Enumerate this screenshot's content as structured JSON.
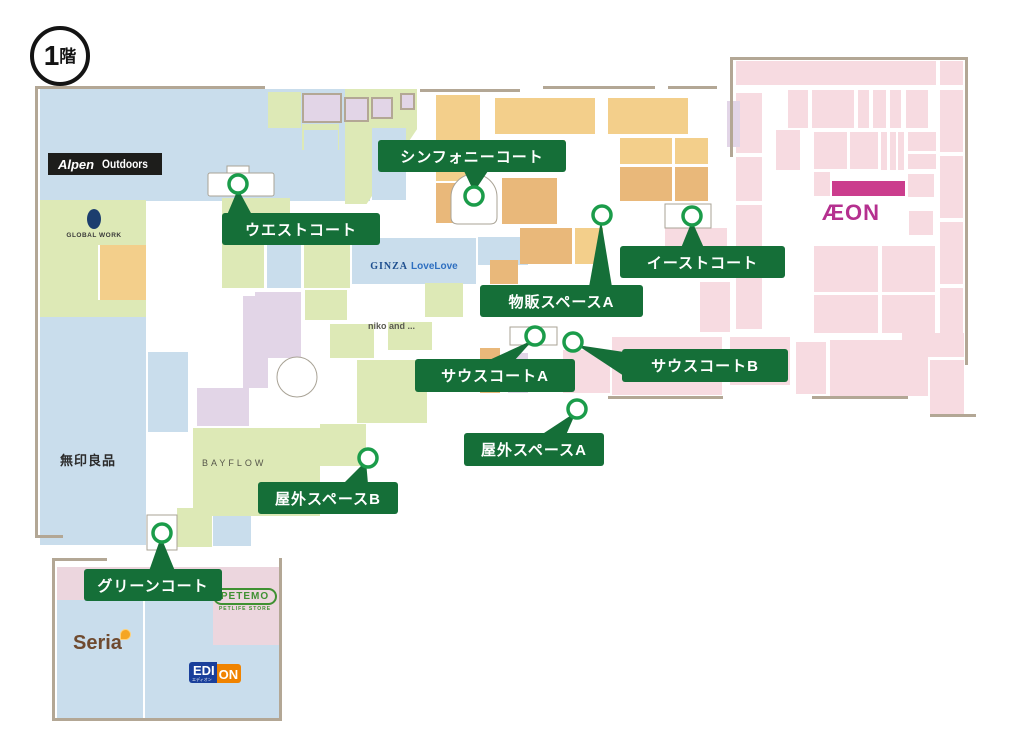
{
  "floor": {
    "number": "1",
    "suffix": "階"
  },
  "areas": {
    "symphony": {
      "label": "シンフォニーコート"
    },
    "west": {
      "label": "ウエストコート"
    },
    "east": {
      "label": "イーストコート"
    },
    "sales_a": {
      "label": "物販スペースA"
    },
    "south_a": {
      "label": "サウスコートA"
    },
    "south_b": {
      "label": "サウスコートB"
    },
    "outdoor_a": {
      "label": "屋外スペースA"
    },
    "outdoor_b": {
      "label": "屋外スペースB"
    },
    "green": {
      "label": "グリーンコート"
    }
  },
  "stores": {
    "alpen_brand": "Alpen",
    "alpen_sub": "Outdoors",
    "global_work": "GLOBAL WORK",
    "ginza_brand": "GINZA",
    "ginza_sub": "LoveLove",
    "niko": "niko and ...",
    "muji": "無印良品",
    "bayflow": "BAYFLOW",
    "aeon": "ÆON",
    "seria": "Seria",
    "petemo": "PETEMO",
    "petemo_sub": "PETLIFE STORE",
    "edion_part1": "EDI",
    "edion_part2": "ON",
    "edion_sub": "エディオン"
  },
  "colors": {
    "area_label_green": "#156f38",
    "marker_ring_green": "#1b9c4a",
    "map_blue": "#c9ddec",
    "map_green": "#dde9b6",
    "map_orange_light": "#f3cf8b",
    "map_orange_dark": "#e9b87a",
    "map_lavender": "#e2d5e7",
    "map_pink": "#f7dbe1",
    "aeon_bar_magenta": "#cb3d8d",
    "aeon_logo_magenta": "#b5308f",
    "wall_tan": "#b3a795"
  }
}
